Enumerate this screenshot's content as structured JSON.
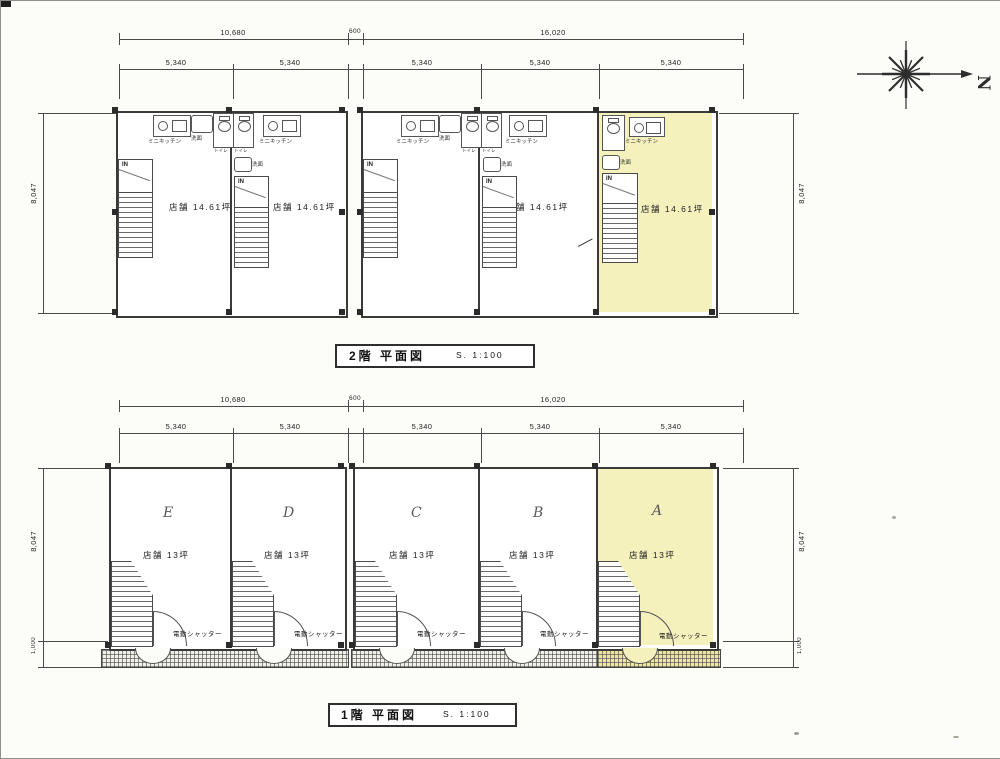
{
  "compass": {
    "north": "N"
  },
  "labels": {
    "in": "IN",
    "mini_kitchen": "ミニキッチン",
    "wash": "洗面",
    "toilet": "トイレ",
    "shutter": "電動シャッター"
  },
  "floor2": {
    "title": "2階 平面図",
    "scale": "S. 1:100",
    "dims": {
      "total_left": "10,680",
      "gap": "600",
      "total_right": "16,020",
      "span": "5,340",
      "height": "8,047"
    },
    "units": [
      {
        "area": "店舗 14.61坪"
      },
      {
        "area": "店舗 14.61坪"
      },
      {
        "area": "店舗 14.61坪"
      },
      {
        "area": "店舗 14.61坪"
      },
      {
        "area": "店舗 14.61坪"
      }
    ]
  },
  "floor1": {
    "title": "1階 平面図",
    "scale": "S. 1:100",
    "dims": {
      "total_left": "10,680",
      "gap": "600",
      "total_right": "16,020",
      "span": "5,340",
      "height": "8,047",
      "walk": "1,000"
    },
    "units": [
      {
        "letter": "E",
        "area": "店舗 13坪"
      },
      {
        "letter": "D",
        "area": "店舗 13坪"
      },
      {
        "letter": "C",
        "area": "店舗 13坪"
      },
      {
        "letter": "B",
        "area": "店舗 13坪"
      },
      {
        "letter": "A",
        "area": "店舗 13坪"
      }
    ]
  },
  "colors": {
    "highlight": "#f5f1bd",
    "line": "#3a3a3a"
  }
}
